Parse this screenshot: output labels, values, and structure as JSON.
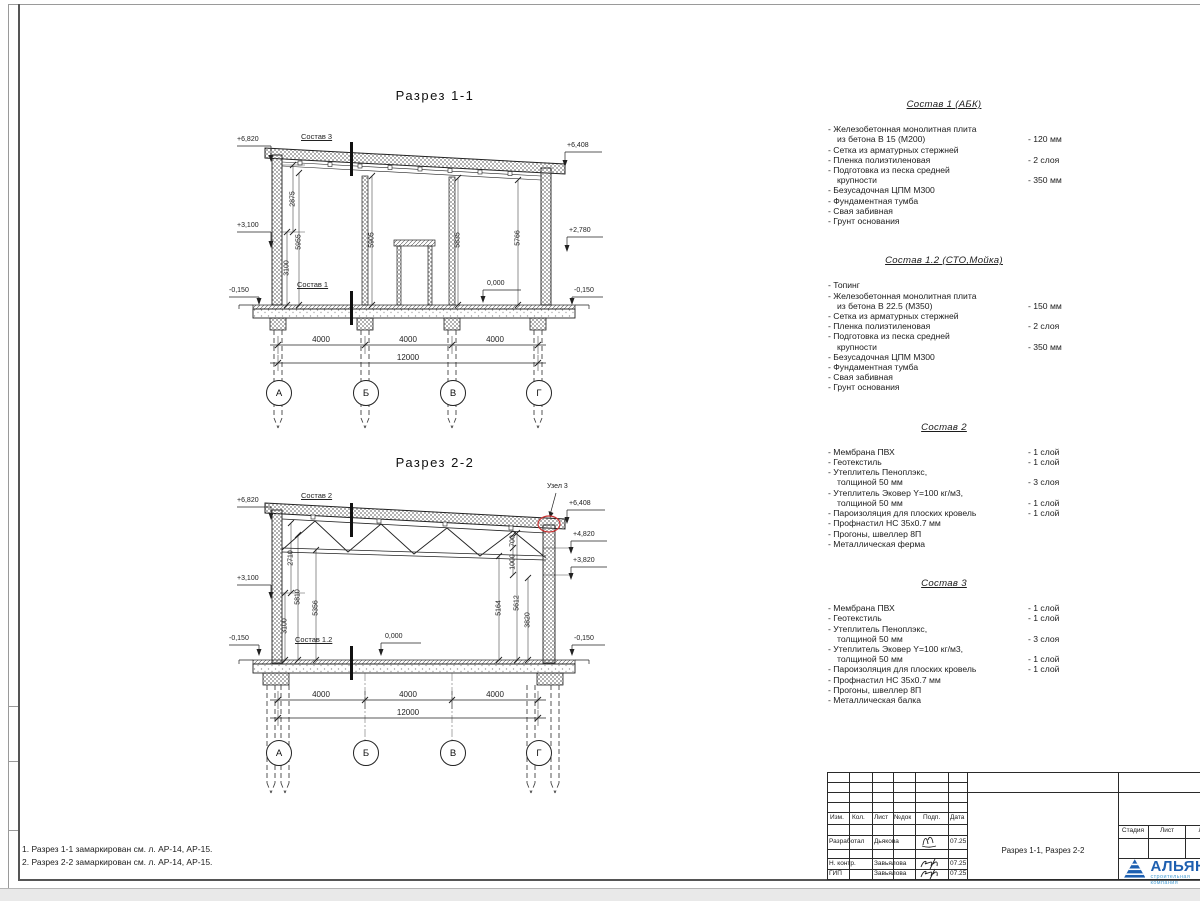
{
  "s11": {
    "title": "Разрез 1-1",
    "cut_labels": [
      "Состав 3",
      "Состав 1"
    ],
    "elev": {
      "tl": "+6,820",
      "ml": "+3,100",
      "bl": "-0,150",
      "floor": "0,000",
      "br": "-0,150",
      "mr": "+2,780",
      "tr": "+6,408"
    },
    "vdims": [
      "2875",
      "5955",
      "3100",
      "5905",
      "5835",
      "5766"
    ],
    "spans": [
      "4000",
      "4000",
      "4000"
    ],
    "total": "12000",
    "axes": [
      "А",
      "Б",
      "В",
      "Г"
    ]
  },
  "s22": {
    "title": "Разрез 2-2",
    "cut_labels": [
      "Состав 2",
      "Состав 1.2"
    ],
    "node_label": "Узел 3",
    "elev": {
      "tl": "+6,820",
      "ml": "+3,100",
      "bl": "-0,150",
      "floor": "0,000",
      "br": "-0,150",
      "tr": "+6,408",
      "r1": "+4,820",
      "r2": "+3,820"
    },
    "vdims_left": [
      "2710",
      "5810",
      "5356",
      "3100"
    ],
    "vdims_right": [
      "700",
      "1000",
      "5612",
      "5164",
      "3820"
    ],
    "spans": [
      "4000",
      "4000",
      "4000"
    ],
    "total": "12000",
    "axes": [
      "А",
      "Б",
      "В",
      "Г"
    ]
  },
  "specs": [
    {
      "title": "Состав 1 (АБК)",
      "items": [
        {
          "l1": "- Железобетонная  монолитная плита",
          "l2": "из бетона В 15 (М200)",
          "v": "- 120 мм"
        },
        {
          "l1": "- Сетка из арматурных стержней"
        },
        {
          "l1": "- Пленка полиэтиленовая",
          "v": "- 2 слоя"
        },
        {
          "l1": "- Подготовка из песка средней",
          "l2": "крупности",
          "v": "- 350 мм"
        },
        {
          "l1": "- Безусадочная ЦПМ М300"
        },
        {
          "l1": "- Фундаментная тумба"
        },
        {
          "l1": "- Свая забивная"
        },
        {
          "l1": "- Грунт основания"
        }
      ]
    },
    {
      "title": "Состав 1.2 (СТО,Мойка)",
      "items": [
        {
          "l1": "- Топинг"
        },
        {
          "l1": "- Железобетонная  монолитная плита",
          "l2": "из бетона В 22.5 (М350)",
          "v": "- 150 мм"
        },
        {
          "l1": "- Сетка из арматурных стержней"
        },
        {
          "l1": "- Пленка полиэтиленовая",
          "v": "- 2 слоя"
        },
        {
          "l1": "- Подготовка из песка средней",
          "l2": "крупности",
          "v": "- 350 мм"
        },
        {
          "l1": "- Безусадочная ЦПМ М300"
        },
        {
          "l1": "- Фундаментная тумба"
        },
        {
          "l1": "- Свая забивная"
        },
        {
          "l1": "- Грунт основания"
        }
      ]
    },
    {
      "title": "Состав 2",
      "items": [
        {
          "l1": "- Мембрана ПВХ",
          "v": "- 1 слой"
        },
        {
          "l1": "- Геотекстиль",
          "v": "- 1 слой"
        },
        {
          "l1": "- Утеплитель Пеноплэкс,",
          "l2": "толщиной 50 мм",
          "v": "- 3 слоя"
        },
        {
          "l1": "- Утеплитель Эковер Y=100 кг/м3,",
          "l2": "толщиной 50 мм",
          "v": "- 1 слой"
        },
        {
          "l1": "- Пароизоляция для плоских кровель",
          "v": "- 1 слой"
        },
        {
          "l1": "- Профнастил НС 35х0.7 мм"
        },
        {
          "l1": "- Прогоны, швеллер 8П"
        },
        {
          "l1": "- Металлическая ферма"
        }
      ]
    },
    {
      "title": "Состав 3",
      "items": [
        {
          "l1": "- Мембрана ПВХ",
          "v": "- 1 слой"
        },
        {
          "l1": "- Геотекстиль",
          "v": "- 1 слой"
        },
        {
          "l1": "- Утеплитель Пеноплэкс,",
          "l2": "толщиной 50 мм",
          "v": "- 3 слоя"
        },
        {
          "l1": "- Утеплитель Эковер Y=100 кг/м3,",
          "l2": "толщиной 50 мм",
          "v": "- 1 слой"
        },
        {
          "l1": "- Пароизоляция для плоских кровель",
          "v": "- 1 слой"
        },
        {
          "l1": "- Профнастил НС 35х0.7 мм"
        },
        {
          "l1": "- Прогоны, швеллер 8П"
        },
        {
          "l1": "- Металлическая балка"
        }
      ]
    }
  ],
  "notes": [
    "1. Разрез 1-1 замаркирован см. л. АР-14, АР-15.",
    "2. Разрез 2-2 замаркирован см. л. АР-14, АР-15."
  ],
  "tb": {
    "cols": [
      "Изм.",
      "Кол.",
      "Лист",
      "№док",
      "Подп.",
      "Дата"
    ],
    "rows": [
      {
        "role": "Разработал",
        "name": "Дьякова",
        "date": "07.25"
      },
      {
        "role": "Н. контр.",
        "name": "Завьялова",
        "date": "07.25"
      },
      {
        "role": "ГИП",
        "name": "Завьялова",
        "date": "07.25"
      }
    ],
    "doc_title": "Разрез 1-1, Разрез 2-2",
    "stage_cols": [
      "Стадия",
      "Лист",
      "Листов"
    ],
    "logo": {
      "name": "АЛЬЯНС",
      "tagline": "строительная компания"
    }
  },
  "colors": {
    "logo_blue": "#1d5fb0",
    "logo_light_blue": "#4a9fd4",
    "node_marker_red": "#cc3333"
  }
}
